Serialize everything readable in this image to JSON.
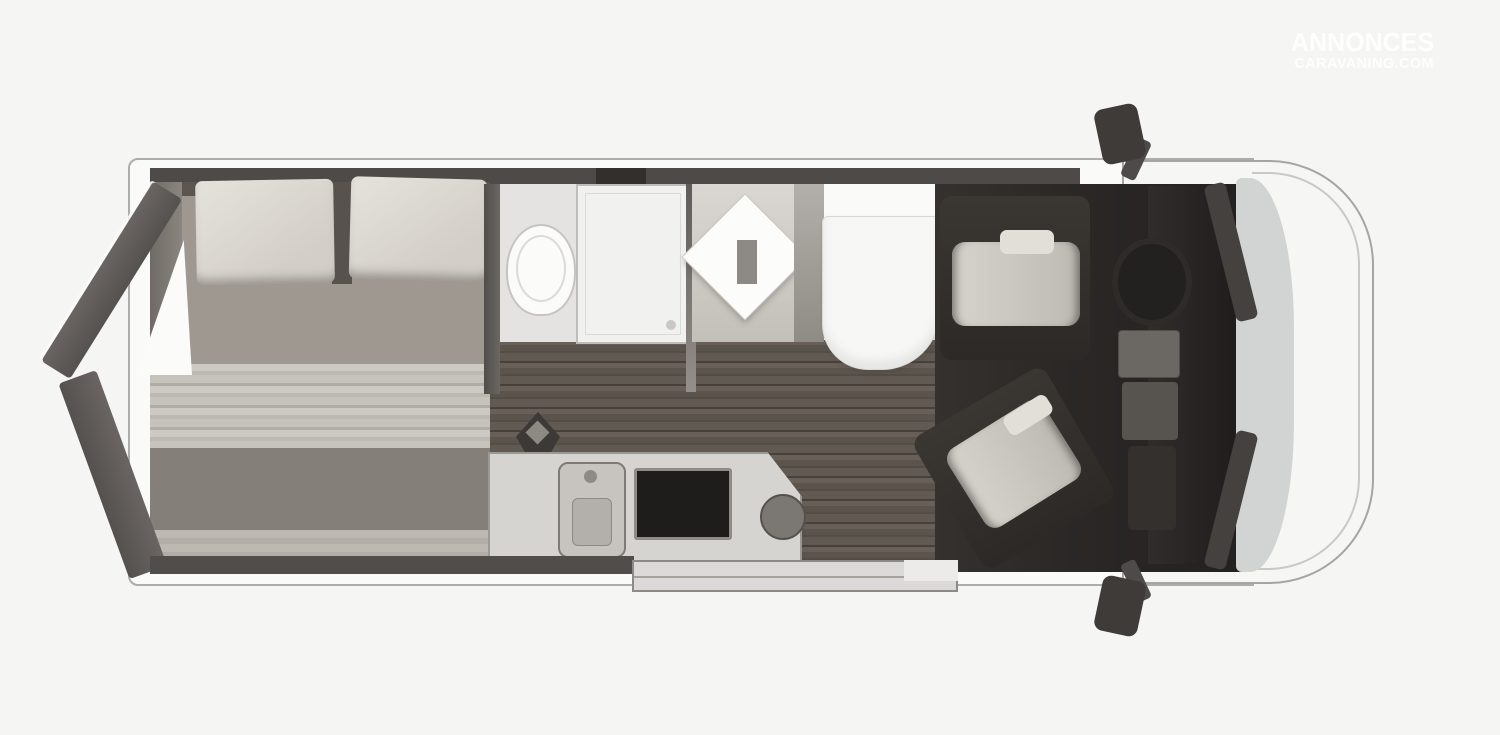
{
  "watermark": {
    "line1": "ANNONCES",
    "line2": "CARAVANING.COM"
  },
  "palette": {
    "background": "#f5f5f4",
    "van_body": "#fafaf9",
    "van_outline": "#aeadab",
    "wall_dark": "#4e4a48",
    "mattress_gray": "#9e9891",
    "pillow_beige": "#dcd8d1",
    "blanket_stripe": "#c6c2bc",
    "wood_floor_light": "#675f58",
    "wood_floor_dark": "#544d46",
    "cab_floor_dark": "#2b2826",
    "white_fixture": "#f7f7f6",
    "counter_gray": "#d6d4d1",
    "stove_black": "#1e1d1c",
    "seat_gray": "#cdc9c3",
    "windshield_glass": "#d2d4d3",
    "step_gray": "#dbdad8",
    "watermark_white": "#ffffff"
  }
}
